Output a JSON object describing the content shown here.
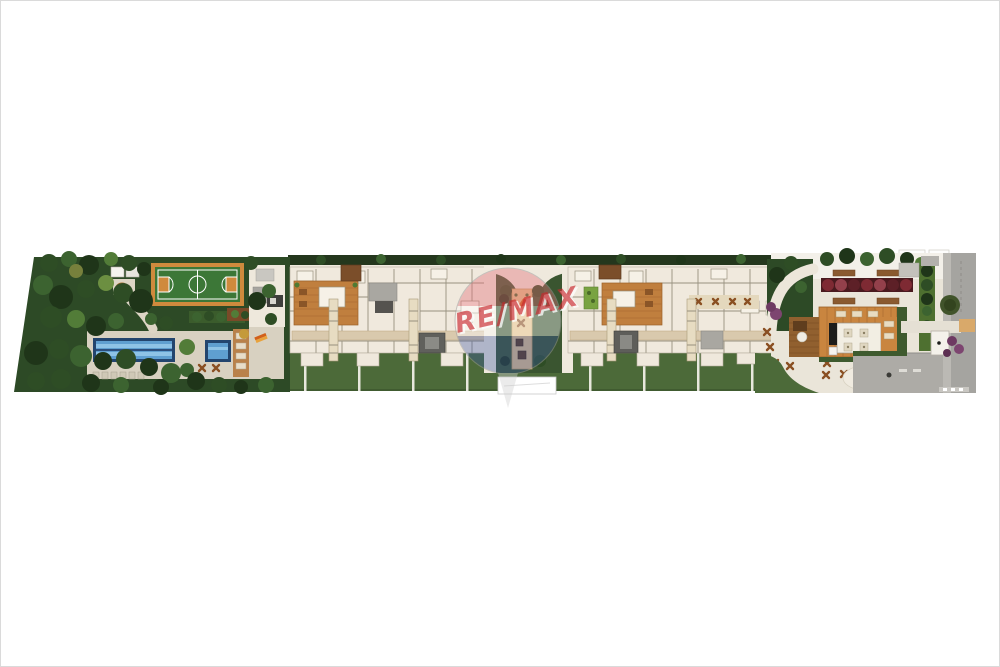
{
  "page": {
    "background": "#ffffff",
    "border_color": "#dadada",
    "content_type": "architectural-site-plan-illustration"
  },
  "watermark": {
    "brand": "RE/MAX",
    "balloon_red": "#d8454d",
    "balloon_white": "#ffffff",
    "balloon_blue": "#27408f",
    "text_red": "#c9262c"
  },
  "palette": {
    "garden_dark_green": "#2d4a26",
    "lawn_green": "#4c6a39",
    "court_green": "#3c7737",
    "court_orange": "#cf8a3d",
    "pool_dark_blue": "#23456e",
    "pool_light_blue": "#8ec3e6",
    "deck_tan": "#d8d1c1",
    "building_cream": "#f0e9dd",
    "wood_orange": "#c07f3e",
    "corridor_tan": "#d9c9ad",
    "planter_red": "#6b222a",
    "pavement_gray": "#a5a4a0",
    "sand_yellow": "#e3c089",
    "white_path": "#efe9dd",
    "purple_shrub": "#7d4570"
  },
  "scene": {
    "elements": [
      "landscaped-garden",
      "multisport-court",
      "barbecue-pavilion",
      "lap-pool",
      "children-pool",
      "pool-deck-with-loungers",
      "tower-a-floor-plan",
      "tower-b-floor-plan",
      "central-playground-strip",
      "perimeter-lawn",
      "amenity-plaza",
      "flower-planters",
      "pergola-party-room",
      "outdoor-tables",
      "entrance-gatehouse",
      "street-sidewalk",
      "remax-watermark"
    ]
  }
}
